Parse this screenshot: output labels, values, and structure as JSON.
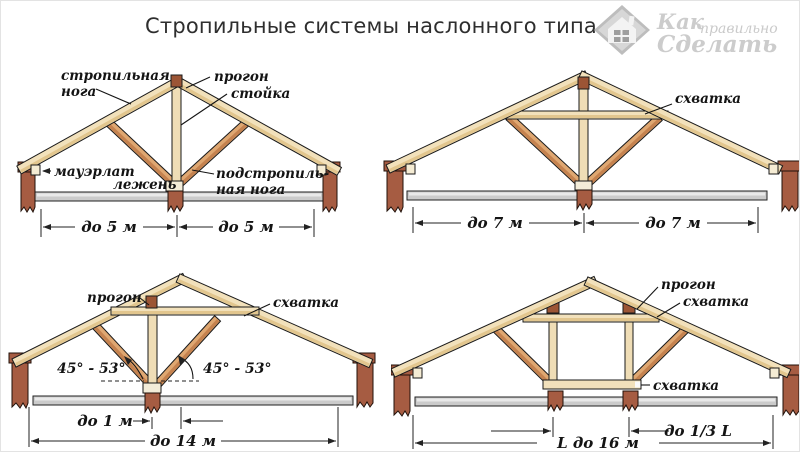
{
  "title": "Стропильные системы наслонного типа",
  "logo": {
    "word1": "Как",
    "word2": "правильно",
    "word3": "Сделать"
  },
  "colors": {
    "wood_light": "#f2e1bb",
    "wood_light_shade": "#e2c68e",
    "wood_mid": "#dfa771",
    "wood_mid_shade": "#c5824f",
    "brick": "#a65c42",
    "purlin_block": "#9c5535",
    "slab": "#cbcbcb",
    "outline": "#1a1a1a",
    "label_ink": "#141414",
    "logo_gray": "#cccccc"
  },
  "trusses": {
    "top_left": {
      "labels": {
        "rafter_line1": "стропильная",
        "rafter_line2": "нога",
        "purlin": "прогон",
        "post": "стойка",
        "mauerlat": "мауэрлат",
        "sleeper": "лежень",
        "underrafter_line1": "подстропиль-",
        "underrafter_line2": "ная нога"
      },
      "dims": {
        "left": "до 5 м",
        "right": "до 5 м"
      }
    },
    "top_right": {
      "labels": {
        "tie": "схватка"
      },
      "dims": {
        "left": "до 7 м",
        "right": "до 7 м"
      }
    },
    "bottom_left": {
      "labels": {
        "purlin": "прогон",
        "tie": "схватка",
        "angle_left": "45° - 53°",
        "angle_right": "45° - 53°"
      },
      "dims": {
        "offset": "до 1 м",
        "span": "до 14 м"
      }
    },
    "bottom_right": {
      "labels": {
        "purlin": "прогон",
        "tie_upper": "схватка",
        "tie_lower": "схватка"
      },
      "dims": {
        "third": "до 1/3 L",
        "span": "L до 16 м"
      }
    }
  }
}
